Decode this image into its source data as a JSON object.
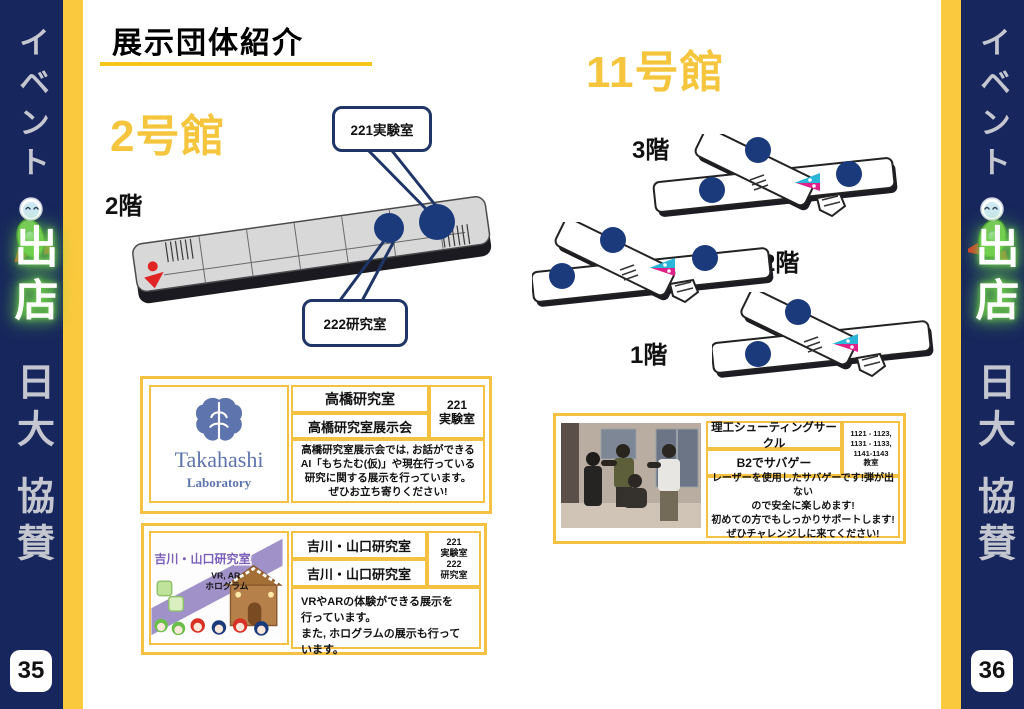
{
  "page_title": "展示団体紹介",
  "banner": {
    "event": "イベント",
    "shop": "出店",
    "nichidai": "日大",
    "kyosan": "協賛"
  },
  "page_numbers": {
    "left": "35",
    "right": "36"
  },
  "building2": {
    "name": "2号館",
    "floor_label": "2階",
    "callout_top": "221実験室",
    "callout_bottom": "222研究室"
  },
  "building11": {
    "name": "11号館",
    "floor3_label": "3階",
    "floor2_label": "2階",
    "floor1_label": "1階"
  },
  "cards": {
    "takahashi": {
      "logo_title": "Takahashi",
      "logo_subtitle": "Laboratory",
      "group_name": "高橋研究室",
      "exhibit_name": "高橋研究室展示会",
      "room": "221\n実験室",
      "description": "高橋研究室展示会では, お話ができる\nAI「もちたむ(仮)」や現在行っている\n研究に関する展示を行っています。\nぜひお立ち寄りください!"
    },
    "yoshikawa": {
      "image_title": "吉川・山口研究室",
      "image_sub1": "VR, AR",
      "image_sub2": "ホログラム",
      "group_name": "吉川・山口研究室",
      "exhibit_name": "吉川・山口研究室",
      "room": "221\n実験室\n222\n研究室",
      "description": "VRやARの体験ができる展示を\n行っています。\nまた, ホログラムの展示も行っています。"
    },
    "shooting": {
      "group_name": "理工シューティングサークル",
      "exhibit_name": "B2でサバゲー",
      "room": "1121 - 1123,\n1131 - 1133,\n1141-1143\n教室",
      "description": "レーザーを使用したサバゲーです!弾が出ない\nので安全に楽しめます!\n初めての方でもしっかりサポートします!\nぜひチャレンジしに来てください!"
    }
  },
  "colors": {
    "navy": "#17265c",
    "stripe_yellow": "#fbc93e",
    "card_border_gold": "#f4c142",
    "heading_yellow": "#f5c63d",
    "room_marker_navy": "#1b3a7c",
    "logo_blue": "#5d74ad"
  }
}
